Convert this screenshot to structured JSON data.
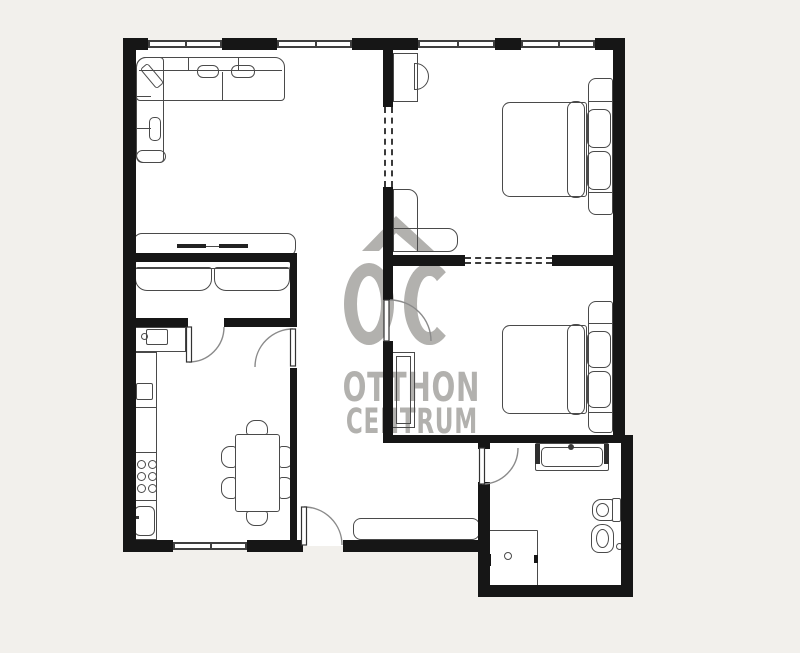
{
  "document": {
    "kind": "real-estate floor plan",
    "visible_text_total": "OC OTTHON CENTRUM"
  },
  "brand": {
    "logo_text": "OC",
    "name_line1": "OTTHON",
    "name_line2": "CENTRUM"
  },
  "colors": {
    "page-bg": "#f2f0ec",
    "floor": "#ffffff",
    "wall": "#161616",
    "line": "#4a4a4a",
    "wm": "#b2b1ae"
  },
  "plan": {
    "rooms": [
      "living-room",
      "small-sofa-room",
      "kitchen-dining",
      "hallway",
      "bedroom-1",
      "bedroom-2",
      "bathroom"
    ],
    "furniture": [
      "l-shaped-sofa",
      "tv-console",
      "two-seat-sofa",
      "kitchen-counter",
      "hob-6-rings",
      "kitchen-sink",
      "dining-table-6-chairs",
      "entry-sideboard",
      "desk-with-chair",
      "corner-bench",
      "double-bed-1",
      "double-bed-2",
      "wardrobe",
      "vanity-washbasin",
      "toilet",
      "bidet",
      "shower"
    ],
    "openings": [
      "entry-door-bottom-wall",
      "kitchen-hall-door",
      "sofa-room-door",
      "bedroom-2-door",
      "bathroom-door",
      "dashed-planned-opening-vertical",
      "dashed-planned-opening-horizontal",
      "windows-top-wall-4",
      "window-bottom-wall-1"
    ]
  }
}
